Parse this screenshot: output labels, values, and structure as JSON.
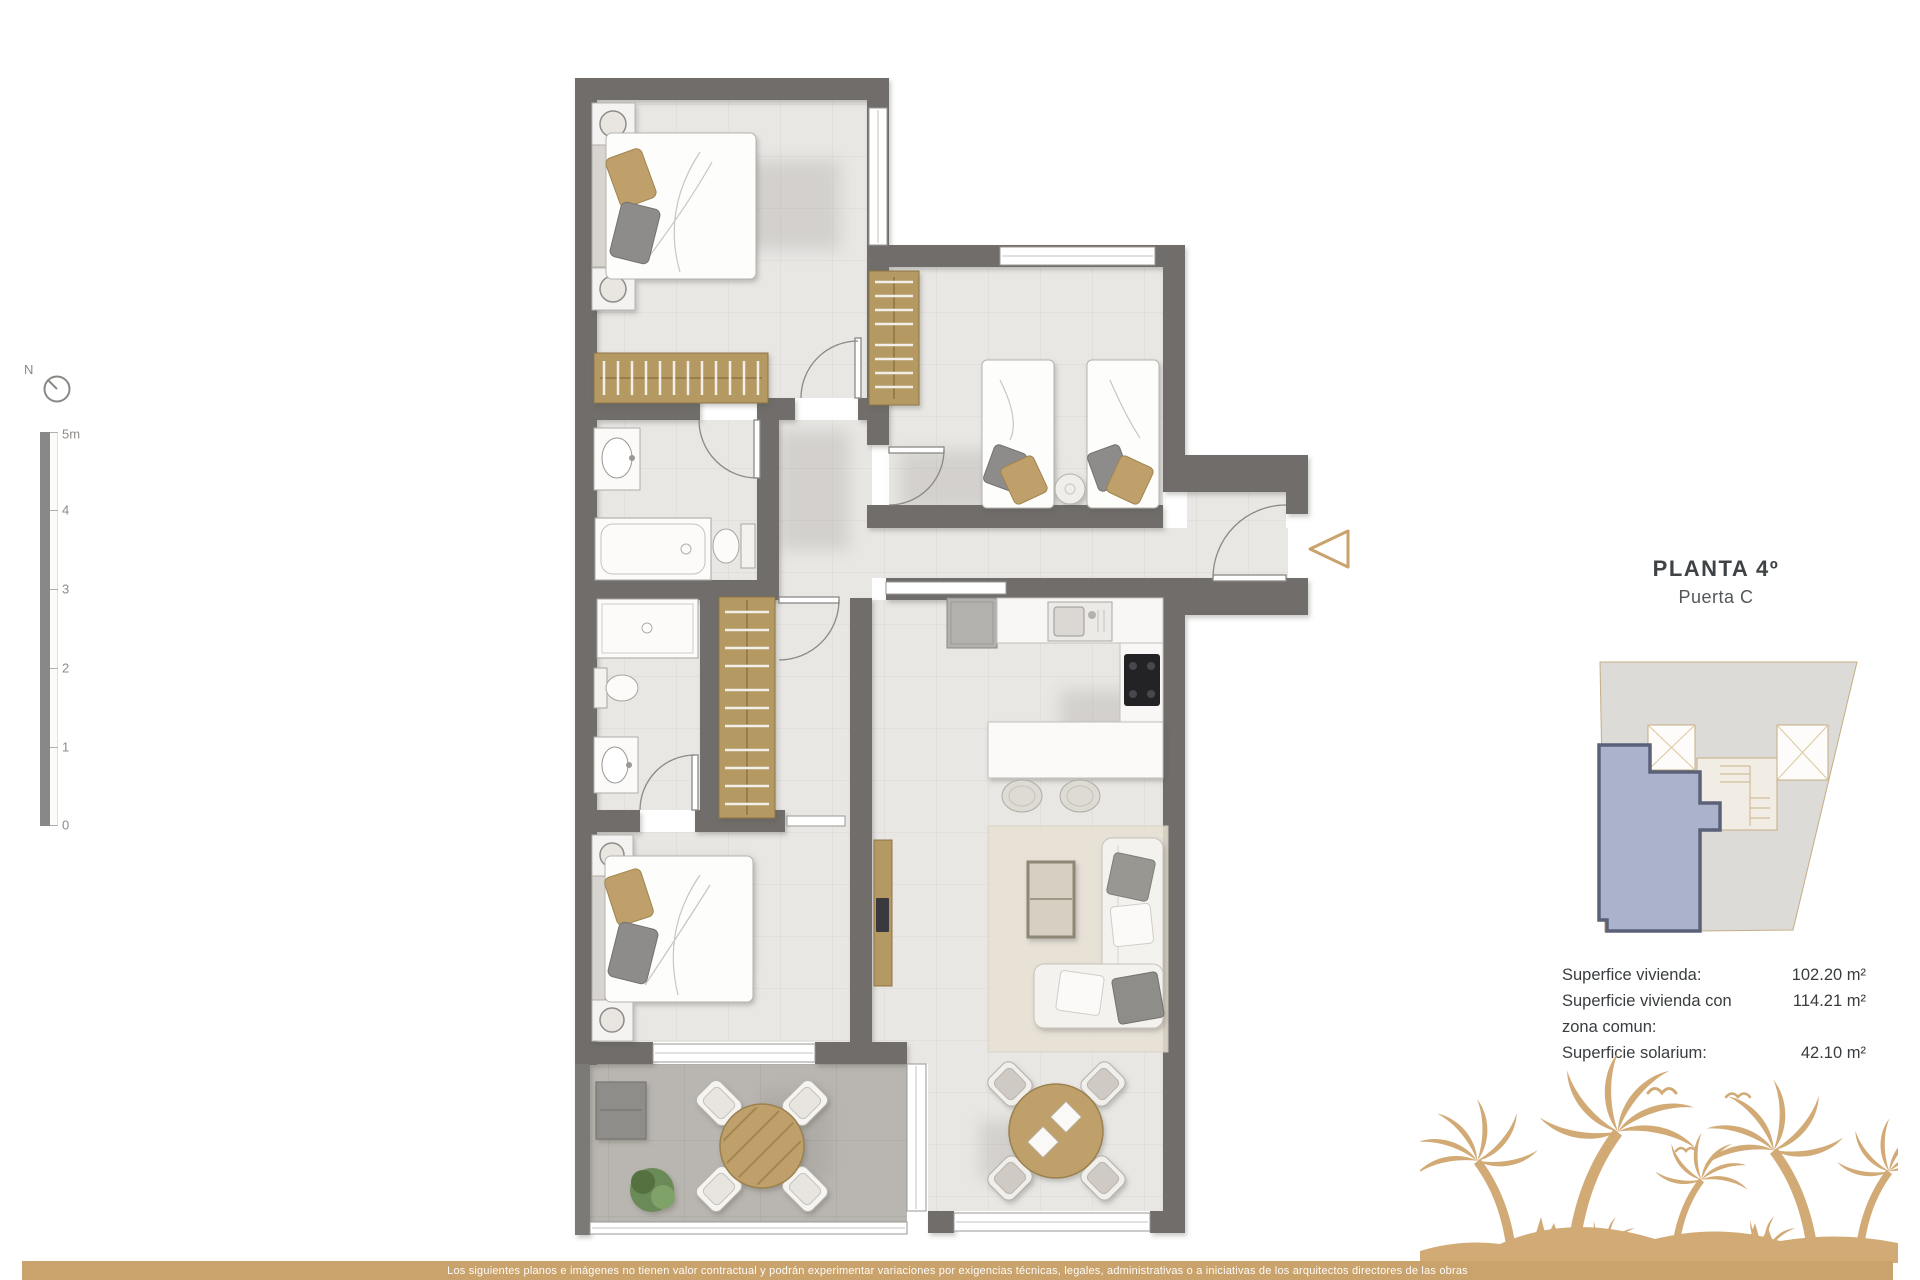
{
  "header": {
    "title": "PLANTA 4º",
    "subtitle": "Puerta C"
  },
  "surfaces": {
    "rows": [
      {
        "label": "Superfice vivienda:",
        "value": "102.20 m²"
      },
      {
        "label": "Superficie vivienda con zona comun:",
        "value": "114.21 m²"
      },
      {
        "label": "Superficie solarium:",
        "value": "42.10 m²"
      }
    ]
  },
  "scale_bar": {
    "labels": [
      "5m",
      "4",
      "3",
      "2",
      "1",
      "0"
    ]
  },
  "compass": {
    "north_label": "N"
  },
  "footer": {
    "disclaimer": "Los siguientes planos e imágenes no tienen valor contractual y podrán experimentar variaciones por exigencias técnicas, legales, administrativas o a iniciativas de los arquitectos directores de las obras"
  },
  "colors": {
    "accent_tan": "#c9a26c",
    "palm_tan": "#d2aa76",
    "wall_gray": "#6f6d6a",
    "floor_tile": "#e9e7e4",
    "terrace_tile": "#b9b5b0",
    "furniture_wood": "#b49963",
    "unit_highlight": "#aab3cb",
    "unit_highlight_border": "#5a6178"
  }
}
